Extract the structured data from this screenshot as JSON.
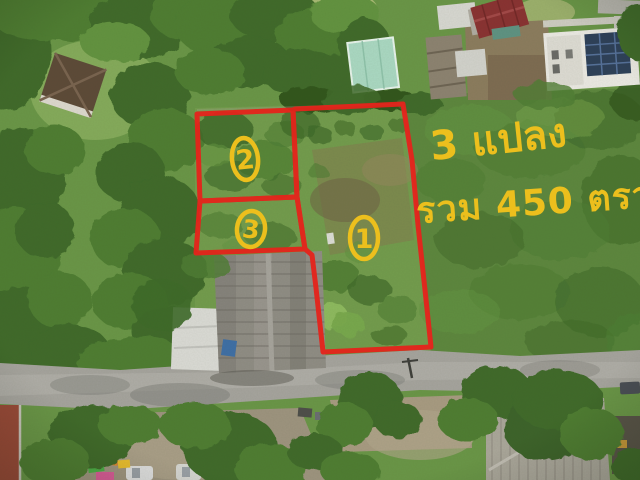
{
  "photo": {
    "description": "Aerial drone photo of vacant land for sale: three plots outlined in red among trees, houses and a road",
    "annotations": {
      "plot_count_label": "3 แปลง",
      "total_area_label": "รวม 450 ตรว.",
      "plot_markers": [
        {
          "number": "1"
        },
        {
          "number": "2"
        },
        {
          "number": "3"
        }
      ],
      "boundary_color": "#e5231b",
      "marker_color": "#ecbf1d"
    }
  }
}
